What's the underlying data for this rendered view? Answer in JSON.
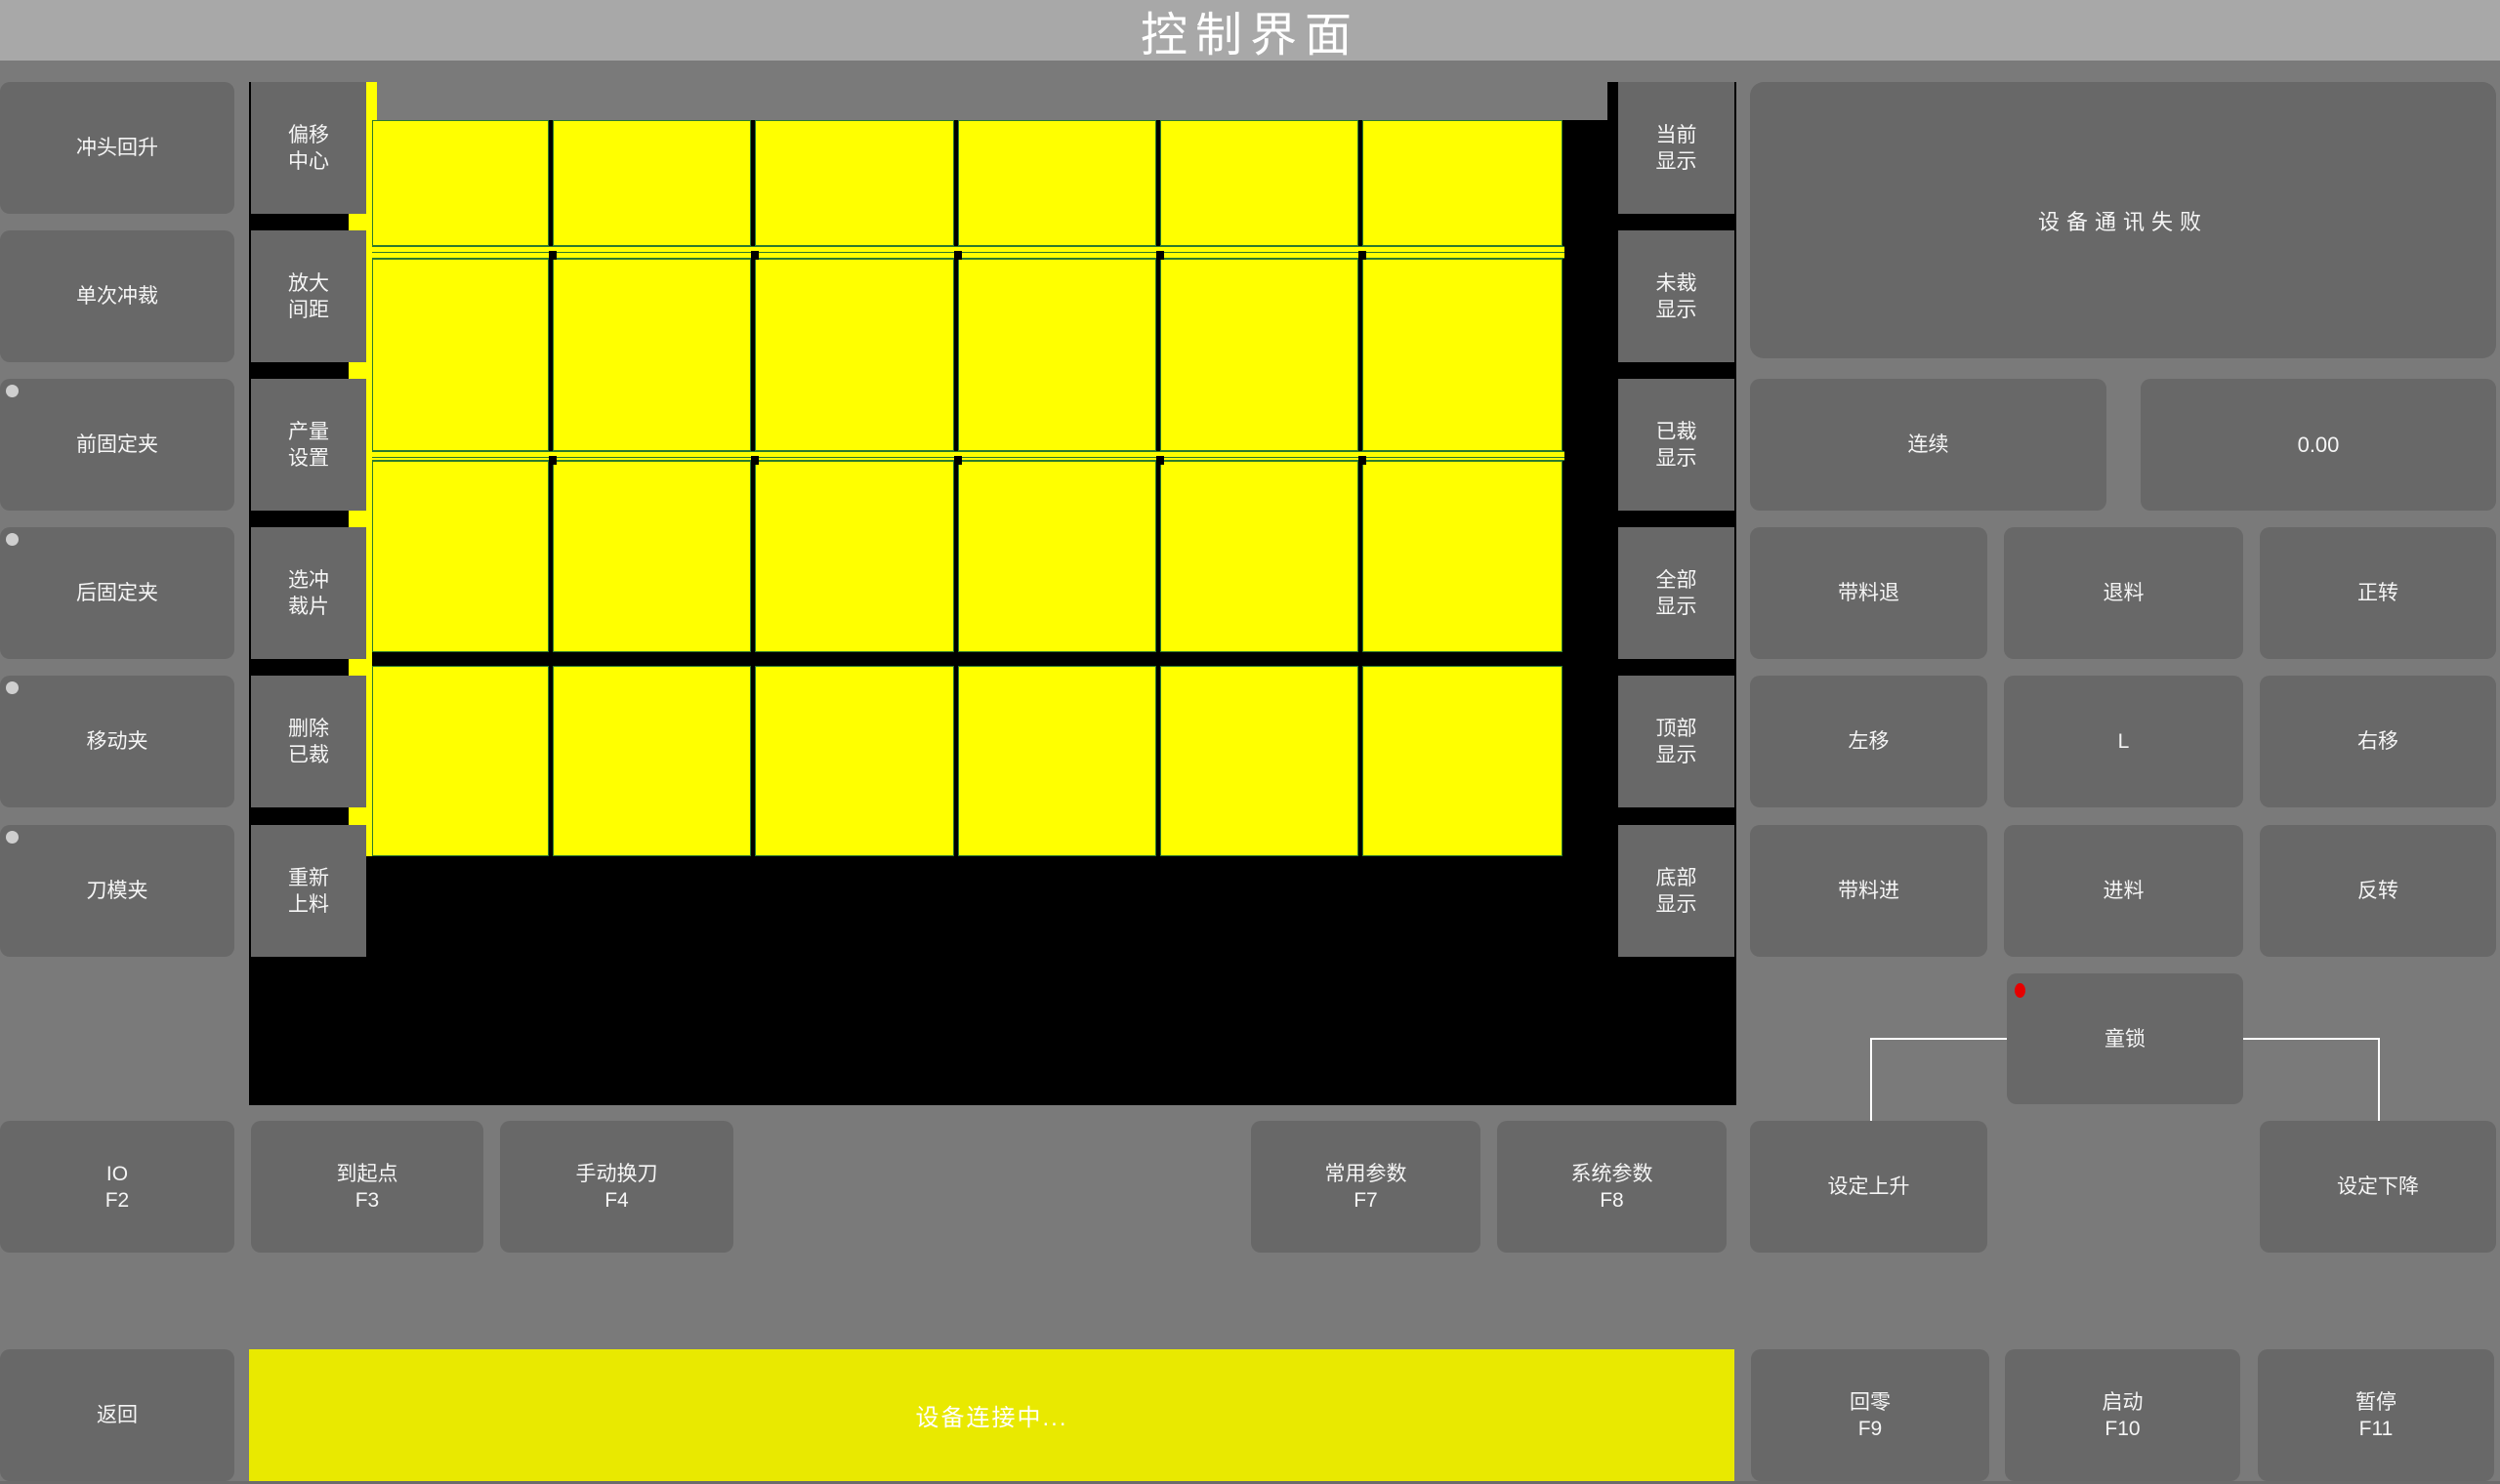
{
  "title": "控制界面",
  "left_buttons": [
    {
      "label": "冲头回升",
      "indicator": false
    },
    {
      "label": "单次冲裁",
      "indicator": false
    },
    {
      "label": "前固定夹",
      "indicator": true
    },
    {
      "label": "后固定夹",
      "indicator": true
    },
    {
      "label": "移动夹",
      "indicator": true
    },
    {
      "label": "刀模夹",
      "indicator": true
    }
  ],
  "left_button_names": [
    "punch-up-button",
    "single-punch-button",
    "front-clamp-button",
    "rear-clamp-button",
    "moving-clamp-button",
    "die-clamp-button"
  ],
  "tool_buttons": [
    {
      "lines": [
        "偏移",
        "中心"
      ]
    },
    {
      "lines": [
        "放大",
        "间距"
      ]
    },
    {
      "lines": [
        "产量",
        "设置"
      ]
    },
    {
      "lines": [
        "选冲",
        "裁片"
      ]
    },
    {
      "lines": [
        "删除",
        "已裁"
      ]
    },
    {
      "lines": [
        "重新",
        "上料"
      ]
    }
  ],
  "tool_button_names": [
    "offset-center-button",
    "enlarge-spacing-button",
    "output-setting-button",
    "select-piece-button",
    "delete-cut-button",
    "reload-material-button"
  ],
  "display_buttons": [
    {
      "lines": [
        "当前",
        "显示"
      ]
    },
    {
      "lines": [
        "未裁",
        "显示"
      ]
    },
    {
      "lines": [
        "已裁",
        "显示"
      ]
    },
    {
      "lines": [
        "全部",
        "显示"
      ]
    },
    {
      "lines": [
        "顶部",
        "显示"
      ]
    },
    {
      "lines": [
        "底部",
        "显示"
      ]
    }
  ],
  "display_button_names": [
    "show-current-button",
    "show-uncut-button",
    "show-cut-button",
    "show-all-button",
    "show-top-button",
    "show-bottom-button"
  ],
  "cut_layout": {
    "type": "grid",
    "columns": 6,
    "rows": 4,
    "piece_count": 24,
    "piece_color": "#ffff00",
    "outline_color": "#2d7a2d",
    "background": "#000000"
  },
  "right_panel": {
    "status_message": "设备通讯失败",
    "mode_button": "连续",
    "value_display": "0.00",
    "jog_buttons": [
      [
        "带料退",
        "退料",
        "正转"
      ],
      [
        "左移",
        "L",
        "右移"
      ],
      [
        "带料进",
        "进料",
        "反转"
      ]
    ],
    "jog_button_names": [
      [
        "strip-back-button",
        "unload-button",
        "forward-rotate-button"
      ],
      [
        "move-left-button",
        "l-button",
        "move-right-button"
      ],
      [
        "strip-feed-button",
        "feed-button",
        "reverse-rotate-button"
      ]
    ],
    "child_lock": "童锁",
    "set_rise": "设定上升",
    "set_fall": "设定下降"
  },
  "function_buttons": [
    {
      "label": "IO",
      "key": "F2"
    },
    {
      "label": "到起点",
      "key": "F3"
    },
    {
      "label": "手动换刀",
      "key": "F4"
    },
    {
      "label": "常用参数",
      "key": "F7"
    },
    {
      "label": "系统参数",
      "key": "F8"
    }
  ],
  "function_button_names": [
    "io-f2-button",
    "origin-f3-button",
    "manual-toolchange-f4-button",
    "common-params-f7-button",
    "system-params-f8-button"
  ],
  "bottom_bar": {
    "back": "返回",
    "status": "设备连接中...",
    "buttons": [
      {
        "label": "回零",
        "key": "F9"
      },
      {
        "label": "启动",
        "key": "F10"
      },
      {
        "label": "暂停",
        "key": "F11"
      }
    ],
    "button_names": [
      "zero-f9-button",
      "start-f10-button",
      "pause-f11-button"
    ]
  }
}
